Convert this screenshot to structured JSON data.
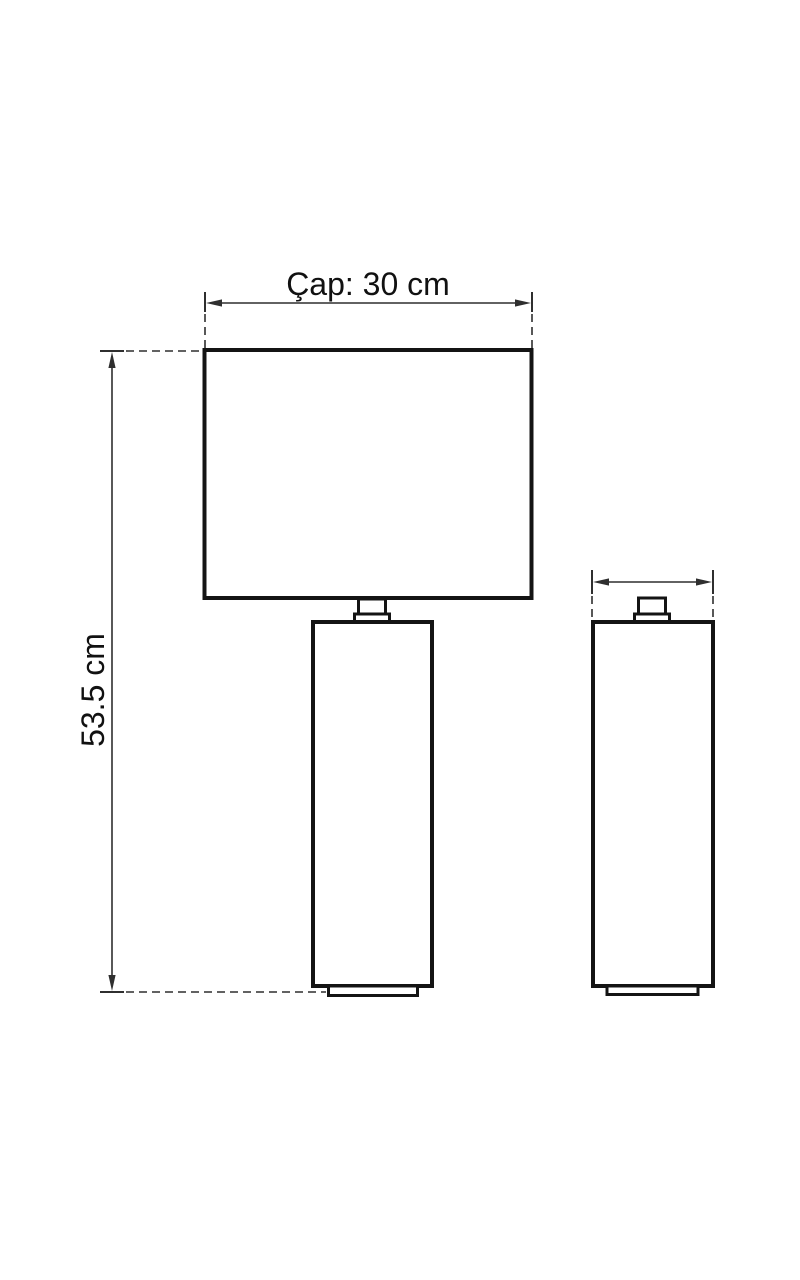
{
  "page": {
    "background": "#ffffff"
  },
  "drawing": {
    "labels": {
      "width_dimension": "Çap: 30 cm",
      "height_dimension": "53.5 cm"
    },
    "colors": {
      "outline": "#141414",
      "dimension": "#2f2f2f",
      "text": "#111111"
    }
  }
}
